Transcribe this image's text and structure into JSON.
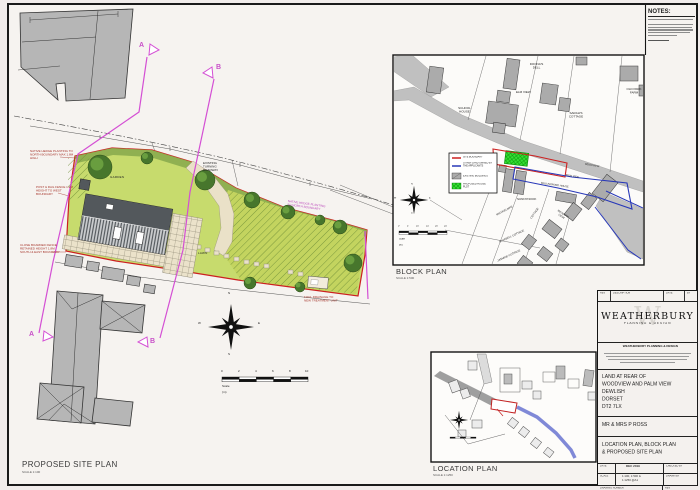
{
  "notes": {
    "heading": "NOTES:"
  },
  "site_plan": {
    "title": "PROPOSED SITE PLAN",
    "scale_label": "SCALE 1:100",
    "garden": "GARDEN",
    "lawn": "LAWN",
    "annotations": {
      "hedge_north": "NATIVE HEDGE PLANTING TO NORTH BOUNDARY MAX 1.8M HIGH",
      "post_rail": "POST & RAIL FENCE 1.2M HEIGHT TO WEST BOUNDARY",
      "close_board": "CLOSE BOARDED FENCE RETAINED HEIGHT 1.8M SOUTH & EAST BOUNDARY",
      "turning": "EXISTING TURNING ROADWAY",
      "hedge_mid": "NATIVE HEDGE PLANTING TO NORTH BOUNDARY",
      "foul": "FOUL DRAINAGE TO NEW TREATMENT UNIT"
    },
    "section_a": "A",
    "section_b": "B",
    "compass": {
      "n": "N",
      "e": "E",
      "s": "S",
      "w": "W"
    },
    "scalebar": {
      "ticks": [
        "0",
        "2",
        "4",
        "6",
        "8",
        "10"
      ],
      "label": "Scale",
      "unit": "(m)"
    }
  },
  "block_plan": {
    "title": "BLOCK PLAN",
    "scale_label": "SCALE 1:500",
    "labels": [
      "DOONA'S DELL",
      "ELM VIEW",
      "SCHOOL HOUSE",
      "SARAH'S COTTAGE",
      "OLD PARK FARM",
      "WOODVIEW",
      "PALM VIEW",
      "WALLINGFORD HOUSE",
      "SUNNYNOOK",
      "MEADOW VIEW",
      "MICHAELMAS",
      "COTTAGE",
      "BLUEBELL COTTAGE",
      "JASMINE COTTAGE"
    ],
    "legend": {
      "items": [
        {
          "label": "SITE BOUNDARY"
        },
        {
          "label": "OTHER LAND OWNED BY THE APPLICANTS"
        },
        {
          "label": "EXISTING BUILDINGS"
        },
        {
          "label": "PROPOSED HOUSE PLOT"
        }
      ]
    },
    "compass": {
      "n": "N",
      "e": "E",
      "s": "S",
      "w": "W"
    },
    "scalebar": {
      "ticks": [
        "0",
        "5",
        "10",
        "15",
        "20",
        "25"
      ],
      "label": "Scale",
      "unit": "(m)"
    }
  },
  "location_plan": {
    "title": "LOCATION PLAN",
    "scale_label": "SCALE 1:1250"
  },
  "title_block": {
    "rev_strip": {
      "rev": "REV",
      "description": "DESCRIPTION",
      "date": "DATE",
      "by": "BY"
    },
    "firm": {
      "name": "WEATHERBURY",
      "tagline": "PLANNING & DESIGN",
      "subheading": "WEATHERBURY PLANNING & DESIGN"
    },
    "project": {
      "line1": "LAND AT REAR OF",
      "line2": "WOODVIEW AND PALM VIEW",
      "line3": "DEWLISH",
      "line4": "DORSET",
      "line5": "DT2 7LX"
    },
    "client": "MR & MRS P ROSS",
    "drawing_title_line1": "LOCATION PLAN, BLOCK PLAN",
    "drawing_title_line2": "& PROPOSED SITE PLAN",
    "fields": {
      "date_label": "DATE",
      "date": "DEC 2019",
      "checked_label": "CHECKED BY",
      "scale_label": "SCALE",
      "scale_line1": "1:100, 1:500 &",
      "scale_line2": "1:1250 @A1",
      "drawn_label": "DRAWN BY",
      "number_label": "DRAWING NUMBER",
      "number": "ROSS-2020-01",
      "rev_label": "REV",
      "rev": "-"
    }
  },
  "colors": {
    "site_green": "#c7db6d",
    "boundary_red": "#cc2020",
    "other_land_blue": "#2838b8",
    "section_magenta": "#d44fd4",
    "building_gray": "#b6b6b6",
    "plot_green": "#35e035"
  }
}
